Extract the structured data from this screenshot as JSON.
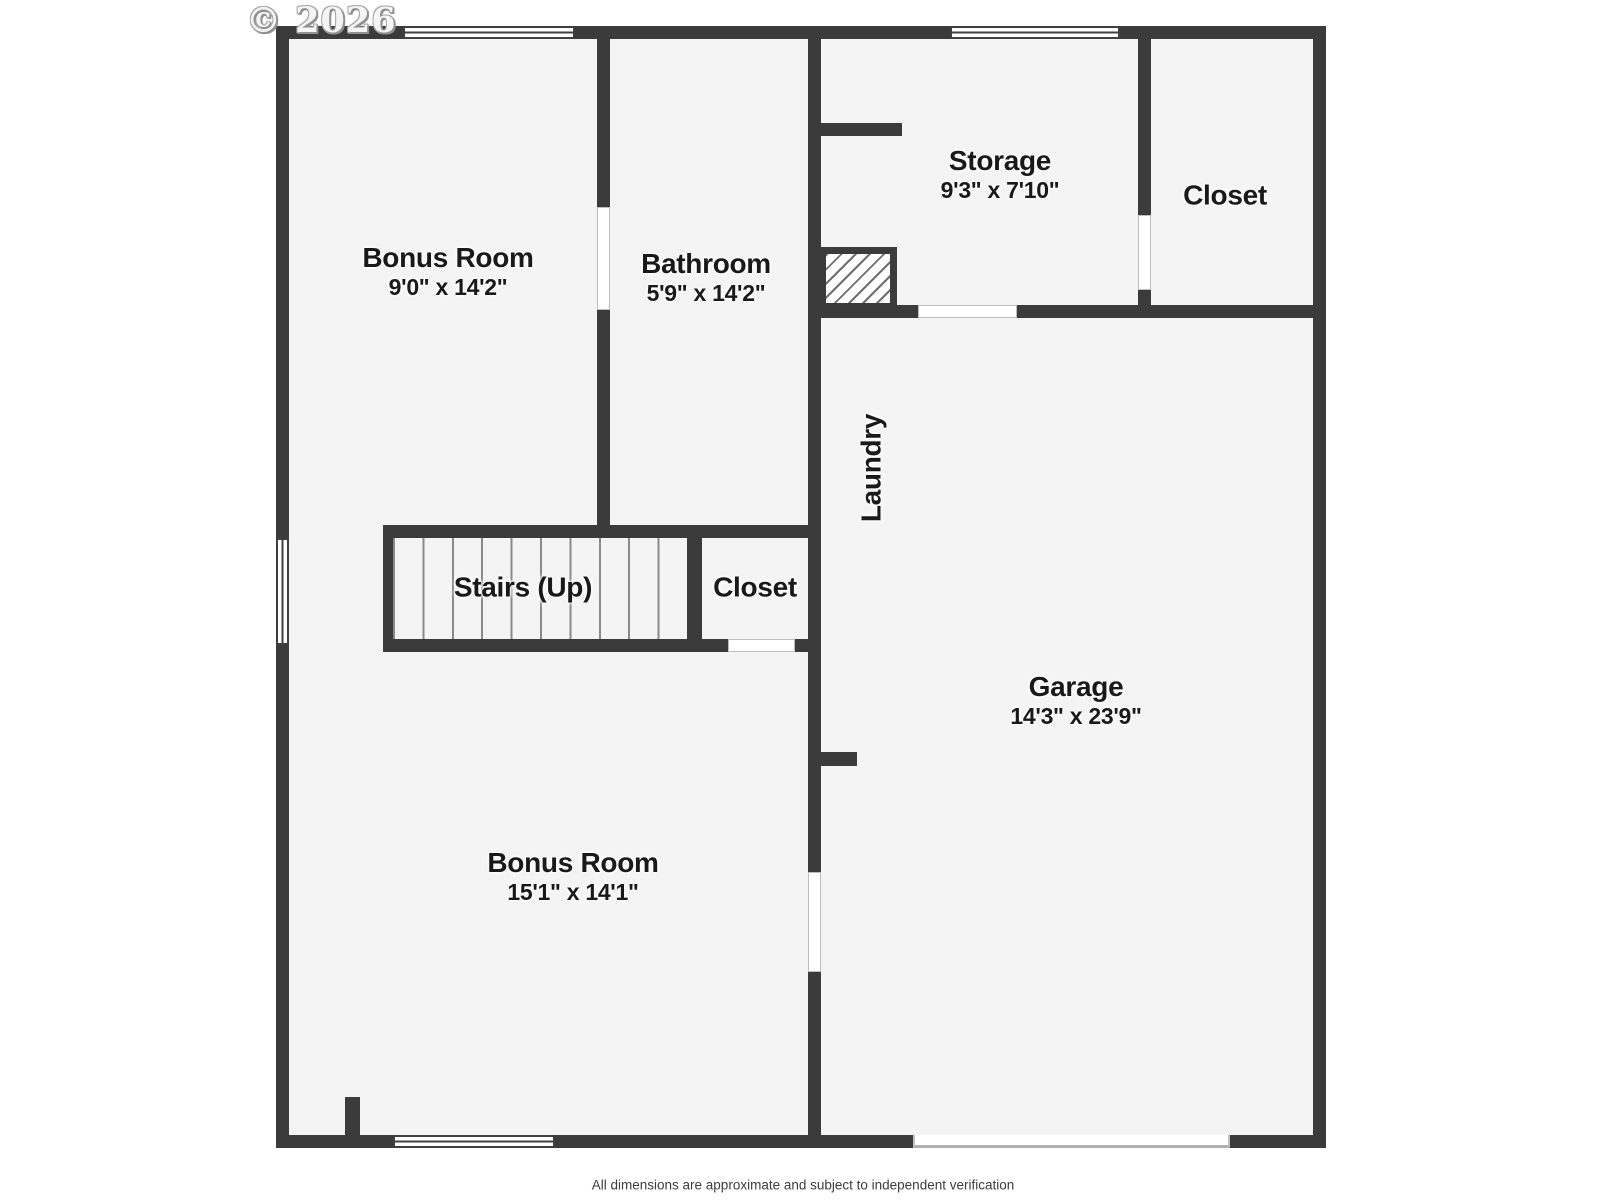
{
  "watermark": "© 2026",
  "footer": "All dimensions are approximate and subject to independent verification",
  "colors": {
    "wall": "#3b3b3b",
    "floor": "#f4f4f4",
    "text": "#191919"
  },
  "rooms": {
    "bonus_top": {
      "name": "Bonus Room",
      "dims": "9'0\" x 14'2\""
    },
    "bathroom": {
      "name": "Bathroom",
      "dims": "5'9\" x 14'2\""
    },
    "storage": {
      "name": "Storage",
      "dims": "9'3\" x 7'10\""
    },
    "closet_top": {
      "name": "Closet"
    },
    "laundry": {
      "name": "Laundry"
    },
    "stairs": {
      "name": "Stairs (Up)"
    },
    "closet_mid": {
      "name": "Closet"
    },
    "garage": {
      "name": "Garage",
      "dims": "14'3\" x 23'9\""
    },
    "bonus_bottom": {
      "name": "Bonus Room",
      "dims": "15'1\" x 14'1\""
    }
  }
}
